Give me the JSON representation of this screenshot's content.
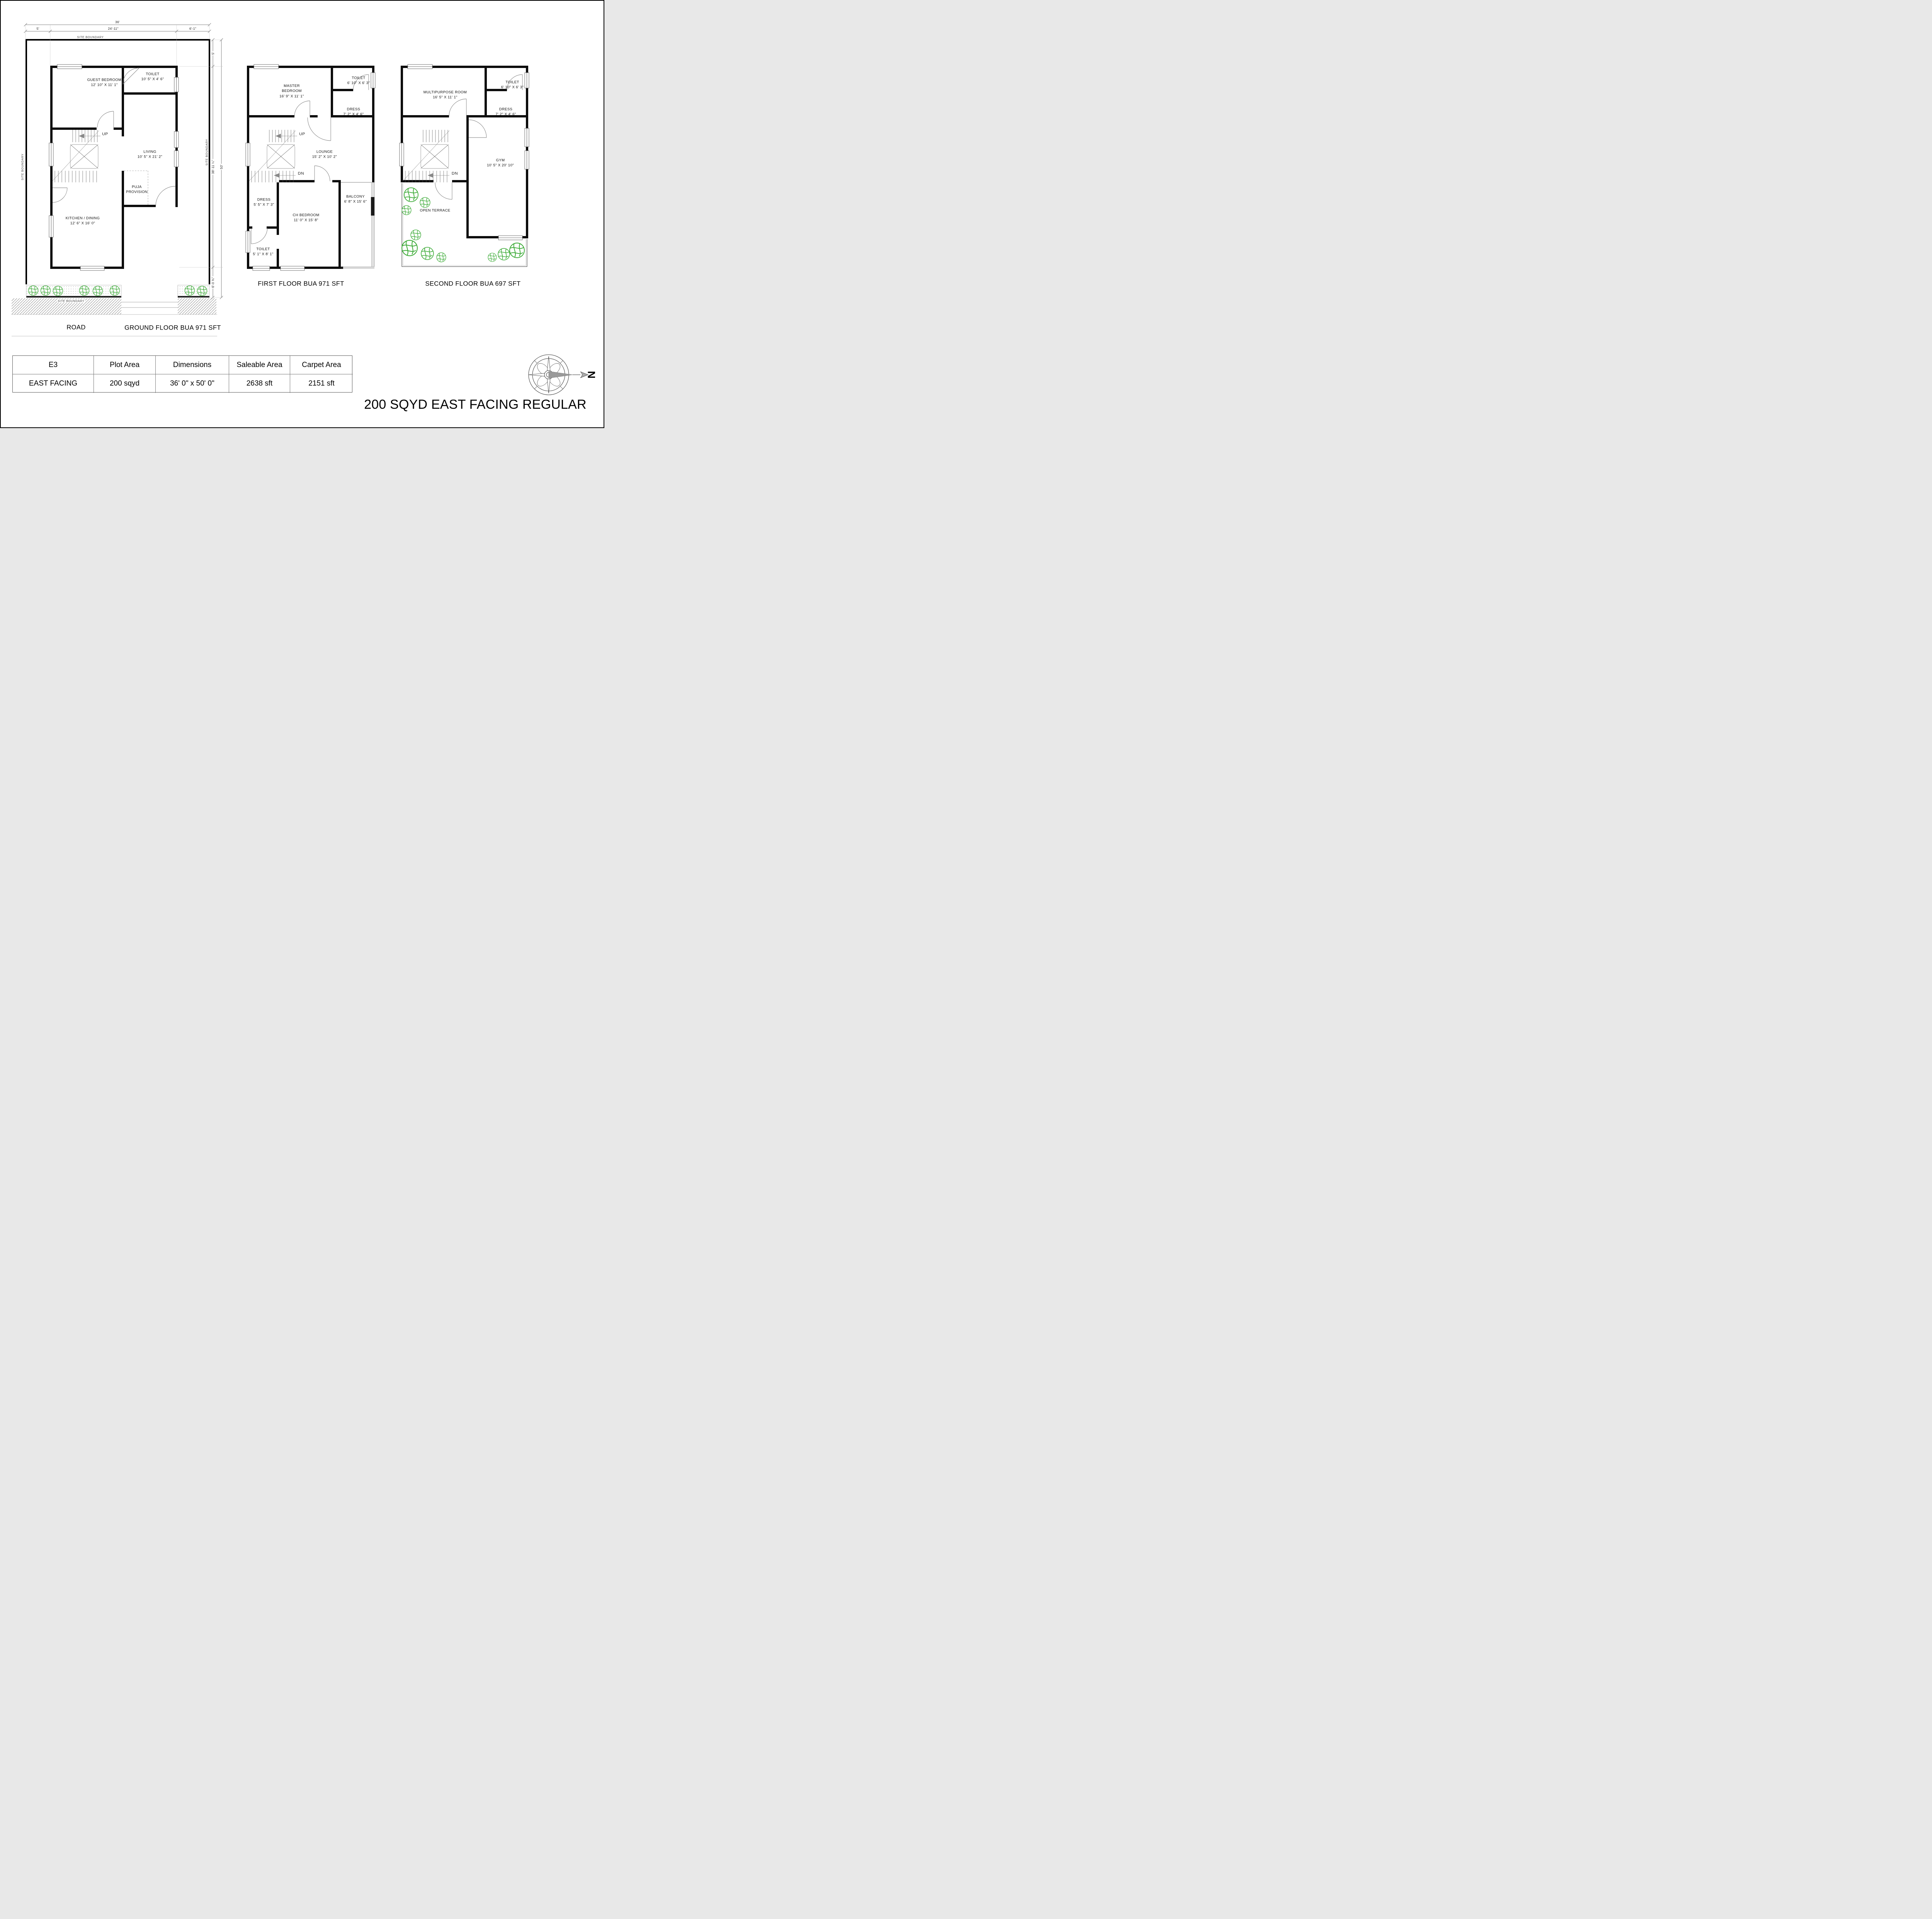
{
  "sheet": {
    "title": "200 SQYD EAST FACING REGULAR"
  },
  "compass": {
    "north": "N"
  },
  "table": {
    "headers": [
      "E3",
      "Plot Area",
      "Dimensions",
      "Saleable Area",
      "Carpet Area"
    ],
    "values": [
      "EAST FACING",
      "200 sqyd",
      "36' 0\" x 50' 0\"",
      "2638 sft",
      "2151 sft"
    ]
  },
  "site": {
    "boundary_label": "SITE BOUNDARY",
    "road_label": "ROAD"
  },
  "dims": {
    "total_width": "36'",
    "left_margin": "5'",
    "building_width": "24'-11\"",
    "right_margin": "6'-1\"",
    "top_margin": "5'",
    "building_depth": "38'-11 ¼\"",
    "total_depth": "50'",
    "bottom_margin": "6'-0 ¾\""
  },
  "ground": {
    "caption": "GROUND FLOOR BUA 971 SFT",
    "up": "UP",
    "guest_bedroom": {
      "name": "GUEST BEDROOM",
      "size": "12' 10\" X 11' 1\""
    },
    "toilet": {
      "name": "TOILET",
      "size": "10' 5\" X 4' 6\""
    },
    "living": {
      "name": "LIVING",
      "size": "10' 5\" X 21' 2\""
    },
    "puja": {
      "name": "PUJA PROVISION"
    },
    "kitchen": {
      "name": "KITCHEN / DINING",
      "size": "12' 6\" X 16' 0\""
    }
  },
  "first": {
    "caption": "FIRST FLOOR BUA 971 SFT",
    "up": "UP",
    "dn": "DN",
    "master": {
      "name": "MASTER BEDROOM",
      "size": "16' 9\" X 11' 1\""
    },
    "toilet_top": {
      "name": "TOILET",
      "size": "6' 10\" X 6' 3\""
    },
    "dress_top": {
      "name": "DRESS",
      "size": "7' 2\" X 4' 6\""
    },
    "lounge": {
      "name": "LOUNGE",
      "size": "15' 2\" X 10' 2\""
    },
    "dress_mid": {
      "name": "DRESS",
      "size": "5' 5\" X 7' 3\""
    },
    "ch_bedroom": {
      "name": "CH BEDROOM",
      "size": "11' 0\" X 15' 8\""
    },
    "balcony": {
      "name": "BALCONY",
      "size": "6' 8\" X 15' 6\""
    },
    "toilet_bottom": {
      "name": "TOILET",
      "size": "5' 1\" X 8' 1\""
    }
  },
  "second": {
    "caption": "SECOND FLOOR BUA 697 SFT",
    "dn": "DN",
    "multipurpose": {
      "name": "MULTIPURPOSE ROOM",
      "size": "16' 5\" X 11' 1\""
    },
    "toilet": {
      "name": "TOILET",
      "size": "6' 10\" X 6' 3\""
    },
    "dress": {
      "name": "DRESS",
      "size": "7' 2\" X 4' 6\""
    },
    "gym": {
      "name": "GYM",
      "size": "10' 5\" X 20' 10\""
    },
    "terrace": {
      "name": "OPEN TERRACE"
    }
  }
}
